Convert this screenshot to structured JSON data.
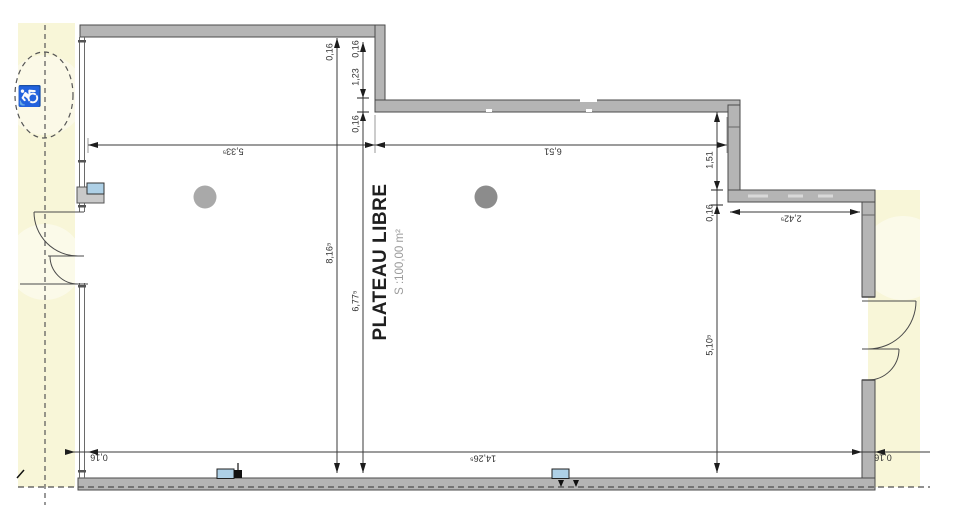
{
  "plan": {
    "room": {
      "name": "PLATEAU LIBRE",
      "area": "S :100,00 m²"
    },
    "icons": {
      "wheelchair": "♿"
    },
    "colors": {
      "wall_fill": "#b5b5b5",
      "wall_outline": "#4a4a4a",
      "zone_yellow": "#f8f6d8",
      "window_blue": "#aed0e6",
      "column_gray_left": "#a9a9a9",
      "column_gray_right": "#8c8c8c",
      "dimension_line": "#3a3a3a"
    },
    "dims": [
      {
        "value": "0,16"
      },
      {
        "value": "0,16"
      },
      {
        "value": "1,23"
      },
      {
        "value": "0,16"
      },
      {
        "value": "5,33⁵"
      },
      {
        "value": "6,51"
      },
      {
        "value": "1,51"
      },
      {
        "value": "0,16"
      },
      {
        "value": "2,42⁵"
      },
      {
        "value": "8,16⁵"
      },
      {
        "value": "6,77⁵"
      },
      {
        "value": "5,10⁵"
      },
      {
        "value": "14,26⁵"
      },
      {
        "value": "0,16"
      },
      {
        "value": "0,16"
      }
    ]
  }
}
